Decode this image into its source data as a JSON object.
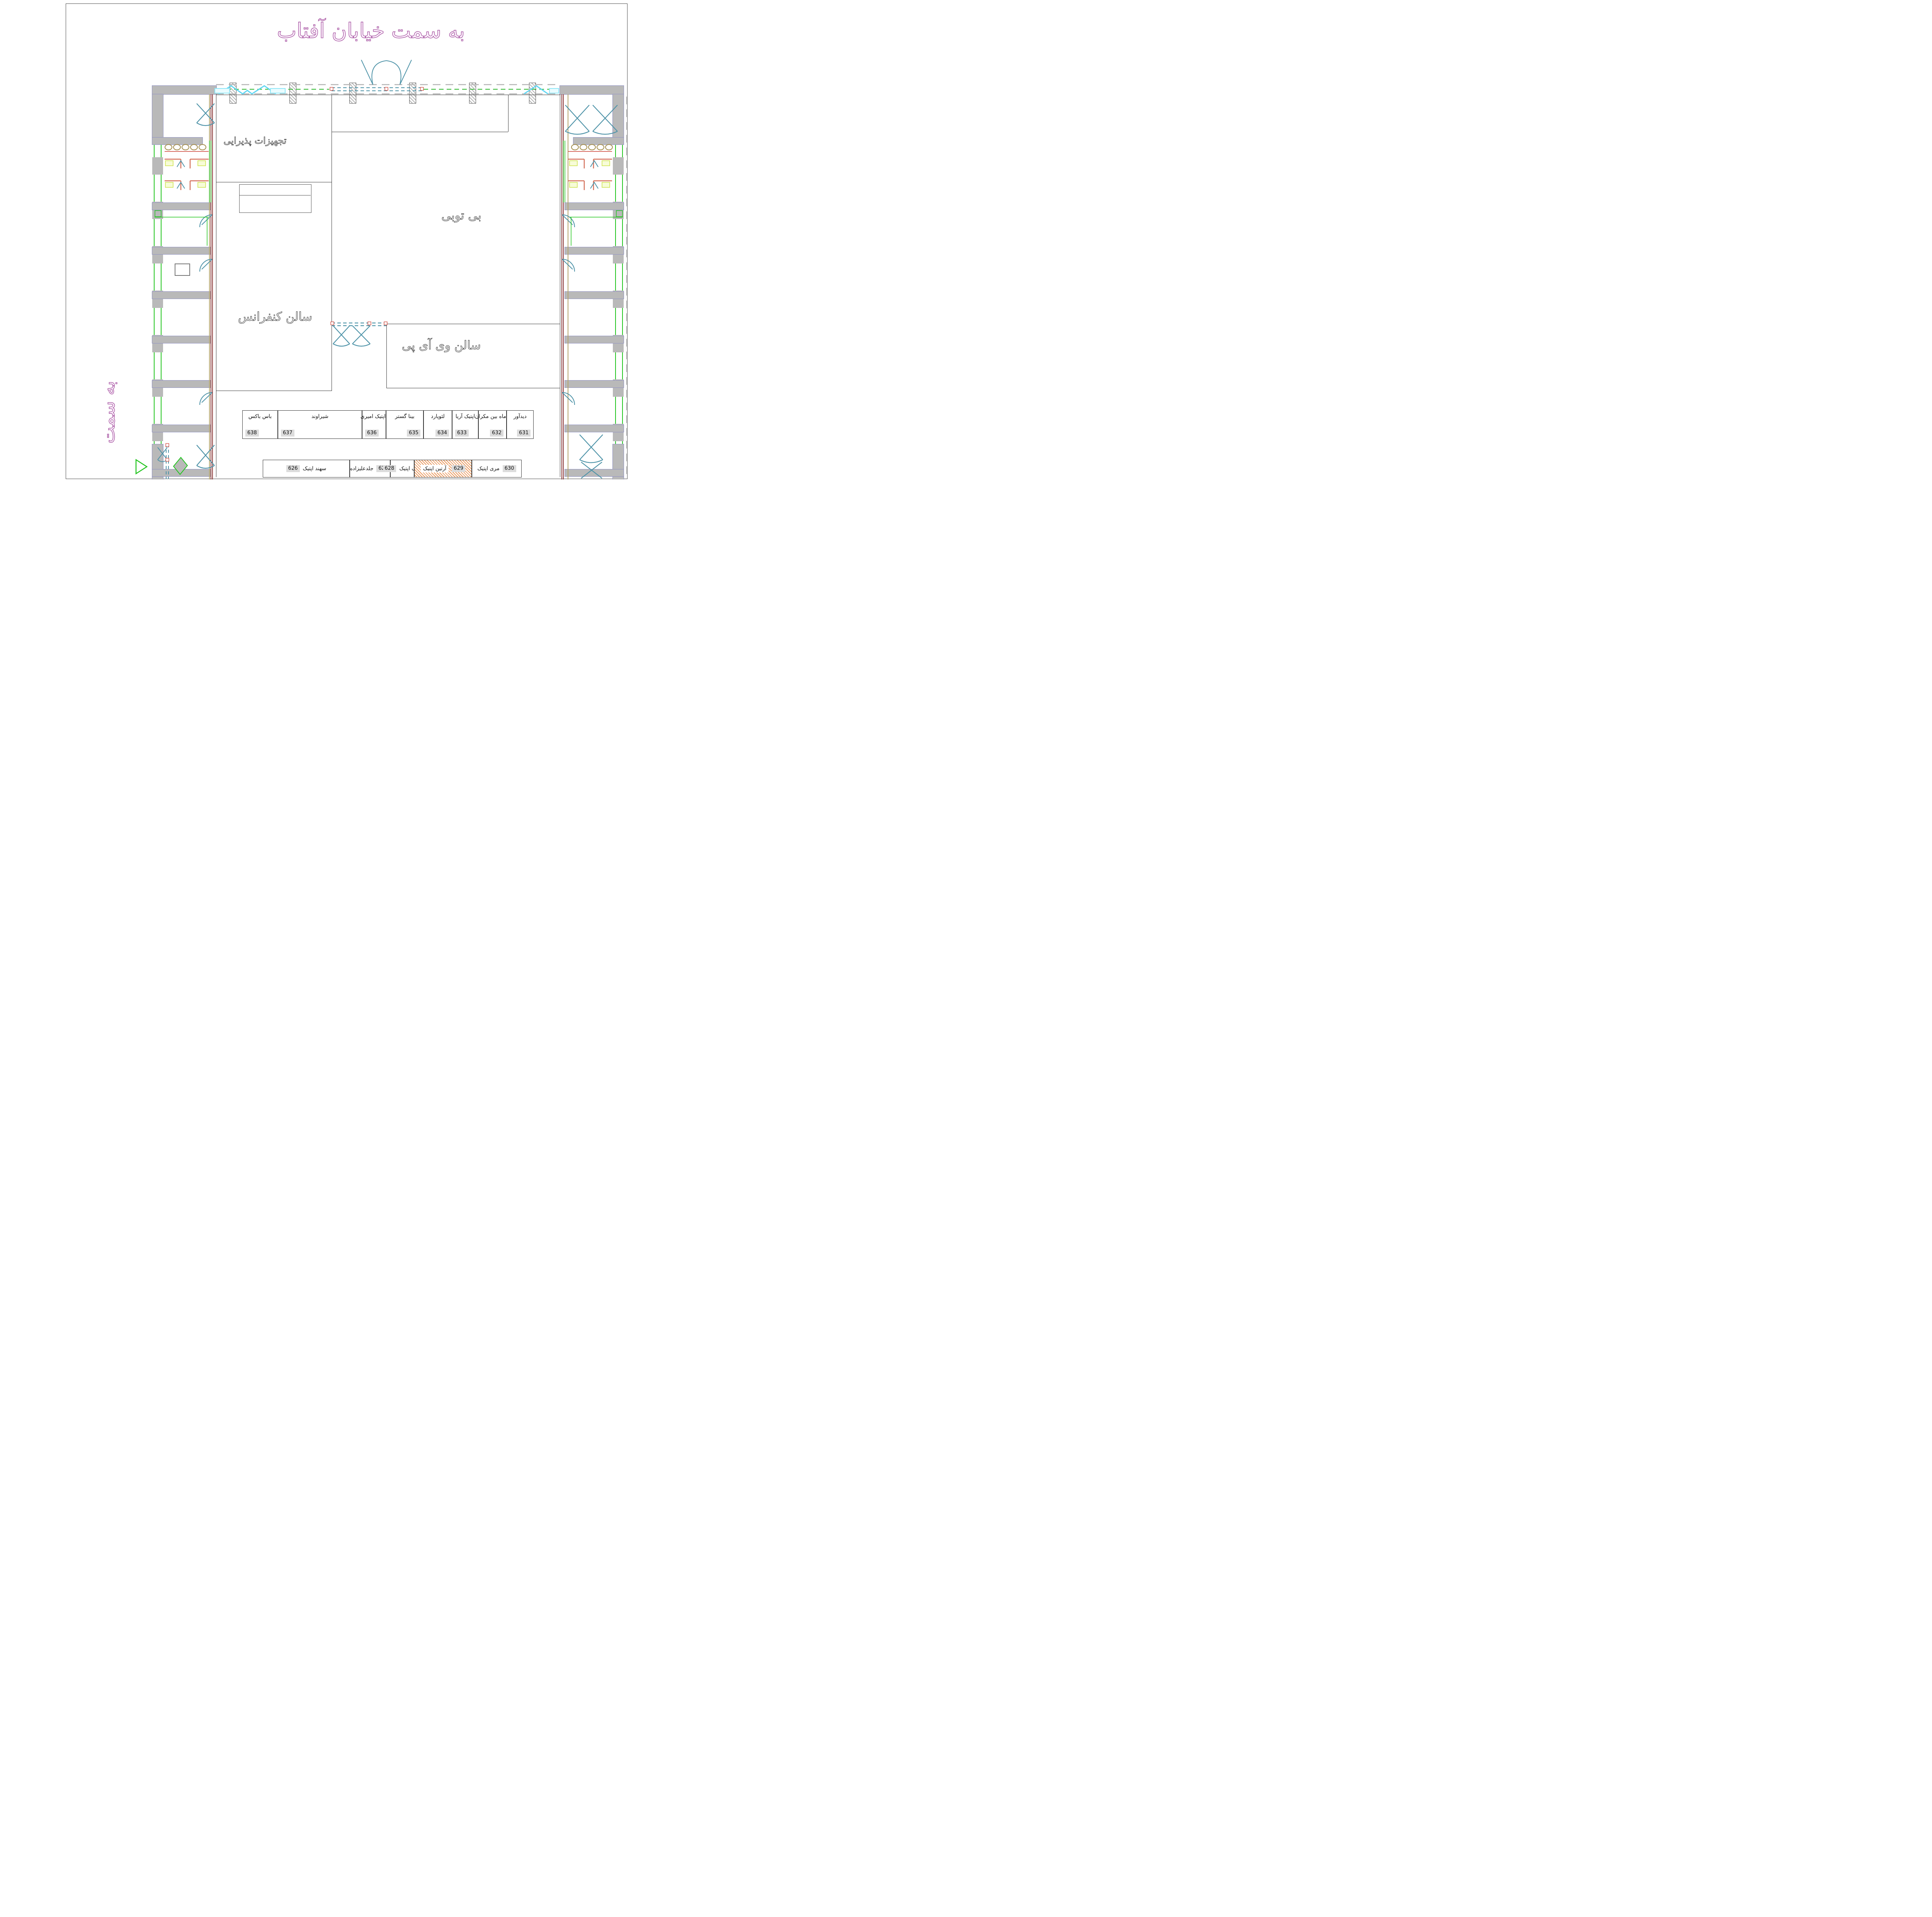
{
  "title": {
    "text": "به سمت خیابان آفتاب"
  },
  "side_label": {
    "text": "به سمت"
  },
  "rooms": {
    "catering": {
      "label": "تجهیزات پذیرایی"
    },
    "btb": {
      "label": "بی توبی"
    },
    "conference": {
      "label": "سالن کنفرانس"
    },
    "vip": {
      "label": "سالن وی آی پی"
    }
  },
  "shop_rows": {
    "top": {
      "units": [
        {
          "no": "638",
          "name": "باس باکس"
        },
        {
          "no": "637",
          "name": "شیراوند"
        },
        {
          "no": "636",
          "name": "اپتیک امیری"
        },
        {
          "no": "635",
          "name": "بینا گستر"
        },
        {
          "no": "634",
          "name": "لئوپارد"
        },
        {
          "no": "633",
          "name": "اپتیک آریا"
        },
        {
          "no": "632",
          "name": "ماه بین مکران"
        },
        {
          "no": "631",
          "name": "دیدآور"
        }
      ]
    },
    "bottom": {
      "units": [
        {
          "no": "626",
          "name": "سهند اپتیک"
        },
        {
          "no": "627",
          "name": "جلدعلیزاده"
        },
        {
          "no": "628",
          "name": "اریک اپتیک"
        },
        {
          "no": "629",
          "name": "آرتین اپتیک",
          "highlighted": "true"
        },
        {
          "no": "630",
          "name": "مری اپتیک"
        }
      ]
    }
  },
  "colors": {
    "title_magenta": "#a653a1",
    "wall_gray": "#b9b9b9",
    "door_teal": "#4e93a8",
    "glazing_cyan": "#5fd6f2",
    "partition_green": "#22c51f",
    "detail_red": "#cc3b2f",
    "stall_orange": "#d4705a",
    "fixture_yellow": "#cde24a",
    "sink_olive": "#a38e4e",
    "badge_gray": "#dcdcdc",
    "highlight_hatch_orange": "#eb9a5f"
  }
}
